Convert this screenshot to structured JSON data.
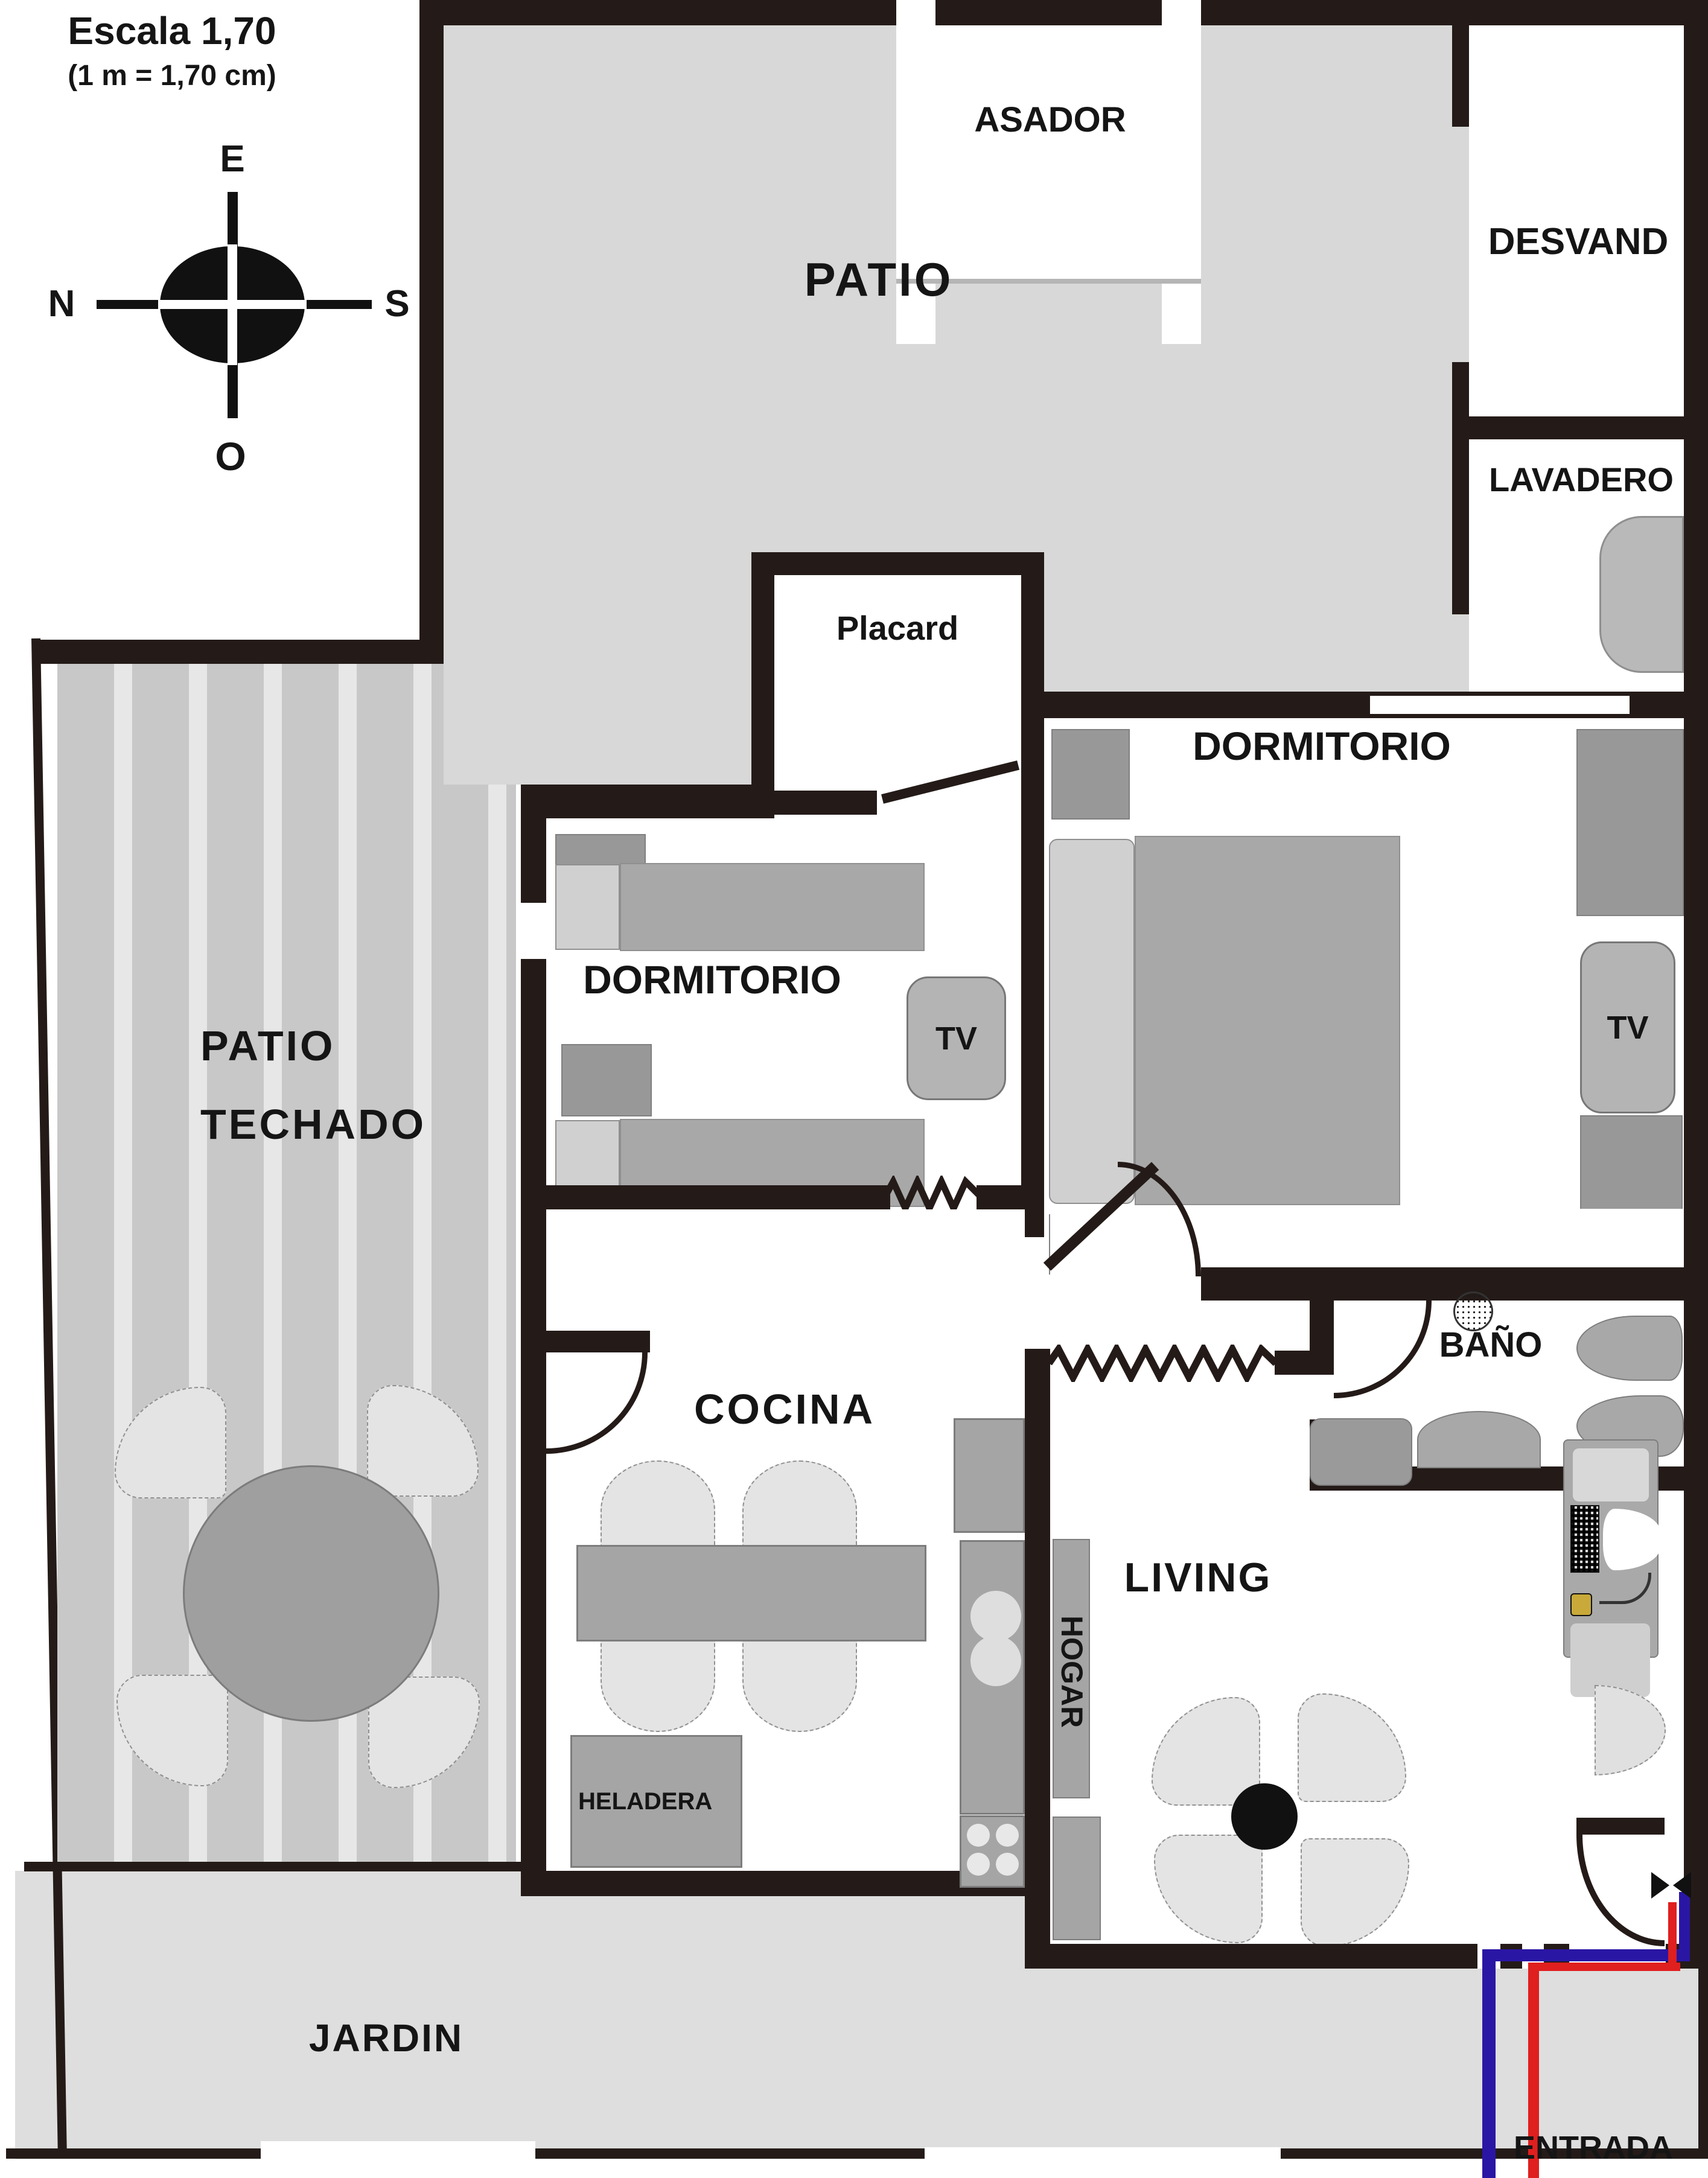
{
  "scale": {
    "title": "Escala 1,70",
    "subtitle": "(1 m = 1,70 cm)"
  },
  "compass": {
    "top": "E",
    "left": "N",
    "right": "S",
    "bottom": "O"
  },
  "rooms": {
    "patio": "PATIO",
    "asador": "ASADOR",
    "desvand": "DESVAND",
    "lavadero": "LAVADERO",
    "placard": "Placard",
    "dormitorio_left": "DORMITORIO",
    "dormitorio_right": "DORMITORIO",
    "patio_techado_line1": "PATIO",
    "patio_techado_line2": "TECHADO",
    "cocina": "COCINA",
    "bano": "BAÑO",
    "living": "LIVING",
    "jardin": "JARDIN",
    "entrada": "ENTRADA"
  },
  "furniture": {
    "tv_left": "TV",
    "tv_right": "TV",
    "heladera": "HELADERA",
    "hogar": "HOGAR"
  },
  "colors": {
    "wall": "#241b18",
    "patio_gray": "#d8d8d8",
    "jardin_gray": "#dedede",
    "furniture_gray": "#a5a5a5",
    "entry_blue": "#2a16a5",
    "entry_red": "#e01f1f"
  }
}
